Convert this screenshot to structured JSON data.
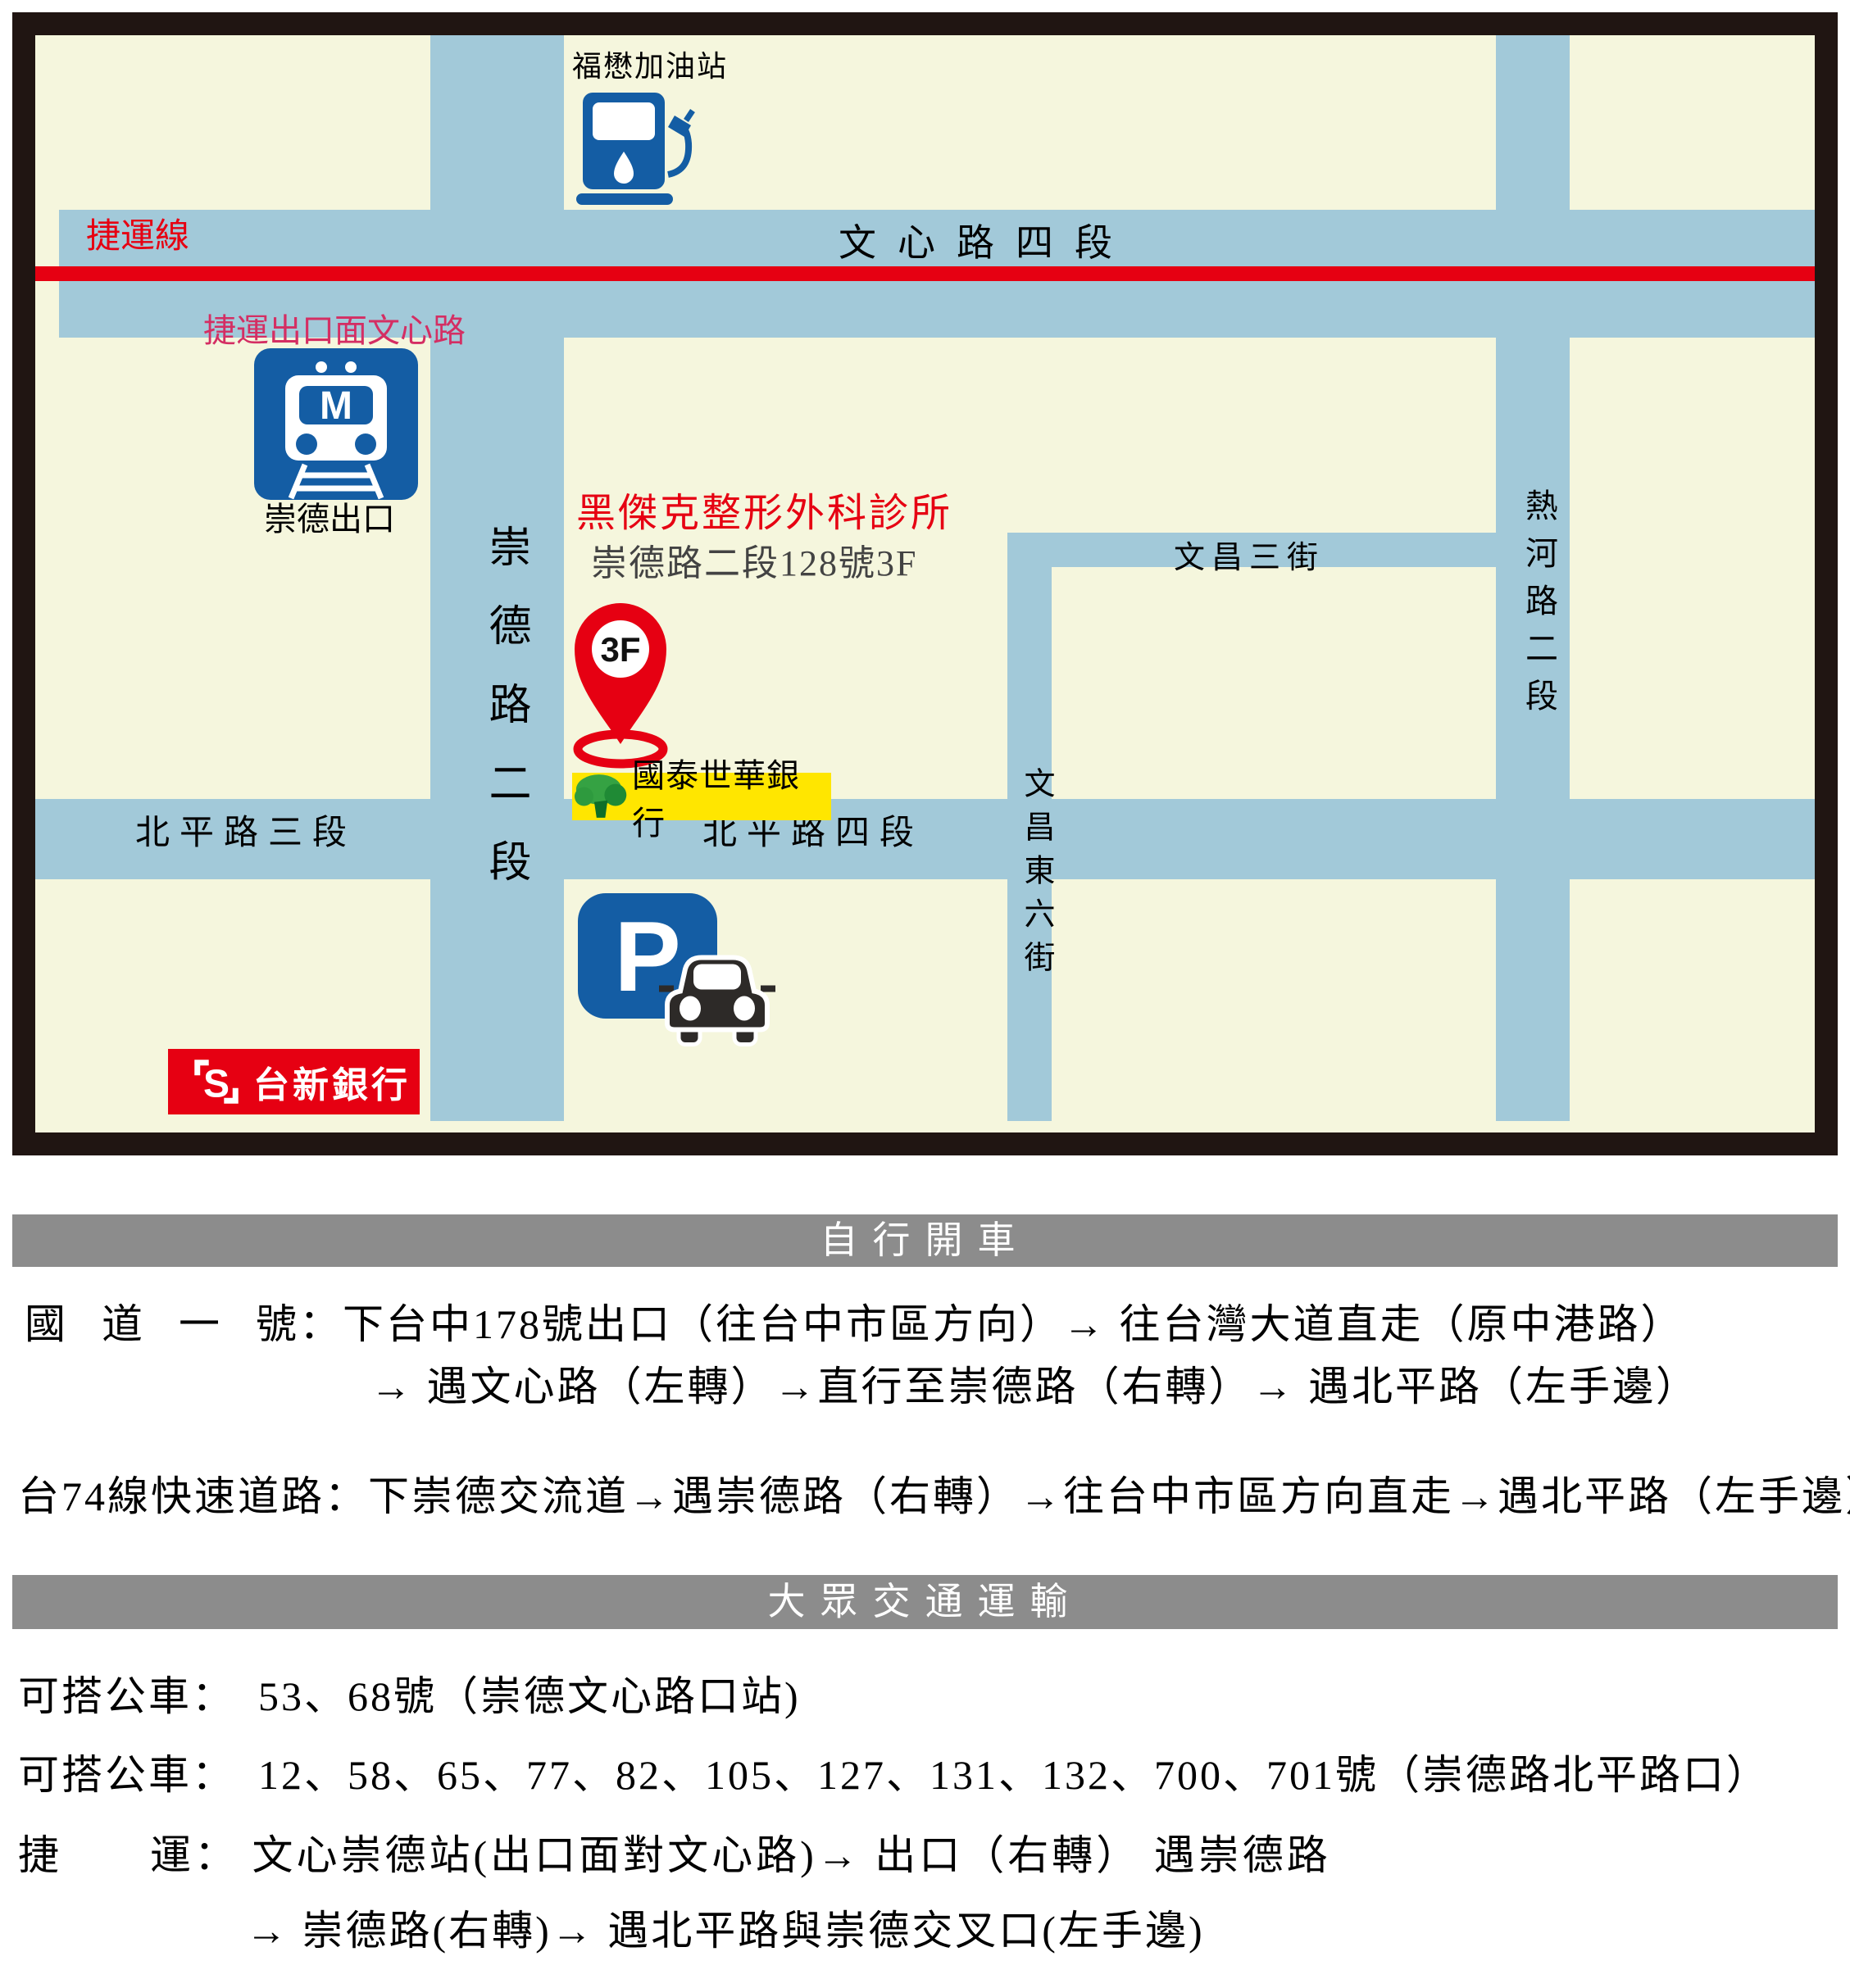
{
  "map": {
    "labels": {
      "mrt_line": "捷運線",
      "wenxin_rd": "文心路四段",
      "mrt_exit_note": "捷運出口面文心路",
      "mrt_exit_name": "崇德出口",
      "gas_station": "福懋加油站",
      "clinic_name": "黑傑克整形外科診所",
      "clinic_address": "崇德路二段128號3F",
      "pin_floor": "3F",
      "cathay_bank": "國泰世華銀行",
      "chongde_rd": "崇德路二段",
      "beiping3_rd": "北平路三段",
      "beiping4_rd": "北平路四段",
      "wenchang3_st": "文昌三街",
      "wenchang_e6_st": "文昌東六街",
      "rehe_rd": "熱河路二段",
      "taishin_bank": "台新銀行",
      "taishin_letter": "S",
      "mrt_letter": "M",
      "parking_letter": "P"
    },
    "colors": {
      "road": "#a2c9d9",
      "cream": "#f5f6dd",
      "mrt_red": "#e60012",
      "icon_blue": "#145da4",
      "highlight_yellow": "#ffe600",
      "note_crimson": "#d42e63"
    }
  },
  "driving": {
    "header": "自行開車",
    "row1_label": "國道一號",
    "row1_colon": "：",
    "row1_text": "下台中178號出口（往台中市區方向）→ 往台灣大道直走（原中港路）",
    "row2_text": "→ 遇文心路（左轉）→直行至崇德路（右轉）→ 遇北平路（左手邊）",
    "row3_label": "台74線快速道路",
    "row3_colon": "：",
    "row3_text": "下崇德交流道→遇崇德路（右轉）→往台中市區方向直走→遇北平路（左手邊）"
  },
  "transit": {
    "header": "大眾交通運輸",
    "bus1_label": "可搭公車：",
    "bus1_text": "53、68號（崇德文心路口站)",
    "bus2_label": "可搭公車：",
    "bus2_text": "12、58、65、77、82、105、127、131、132、700、701號（崇德路北平路口）",
    "mrt_label": "捷運",
    "mrt_colon": "：",
    "mrt_text": "文心崇德站(出口面對文心路)→ 出口（右轉） 遇崇德路",
    "mrt_text2": "→ 崇德路(右轉)→ 遇北平路與崇德交叉口(左手邊)"
  }
}
